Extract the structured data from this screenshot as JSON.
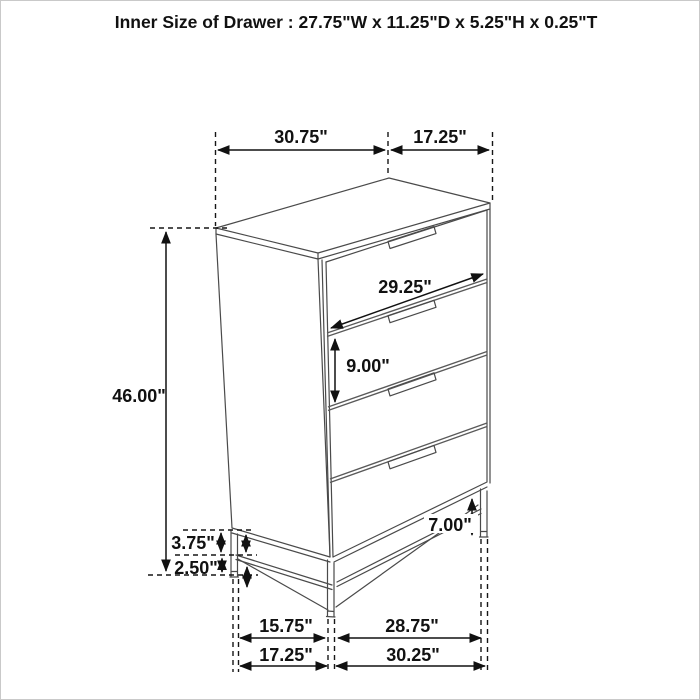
{
  "title": "Inner Size of Drawer : 27.75\"W x 11.25\"D x 5.25\"H x 0.25\"T",
  "diagram": {
    "subject": "four-drawer chest dimension drawing",
    "inner_drawer": {
      "width": "27.75\"W",
      "depth": "11.25\"D",
      "height": "5.25\"H",
      "thickness": "0.25\"T"
    },
    "labels": {
      "top_width": "30.75\"",
      "top_depth": "17.25\"",
      "drawer_width": "29.25\"",
      "drawer_pitch": "9.00\"",
      "overall_height": "46.00\"",
      "frame_upper_gap": "3.75\"",
      "frame_lower_gap": "2.50\"",
      "leg_height": "7.00\"",
      "base_inner_width": "15.75\"",
      "base_inner_depth": "28.75\"",
      "base_outer_width": "17.25\"",
      "base_outer_depth": "30.25\""
    }
  }
}
